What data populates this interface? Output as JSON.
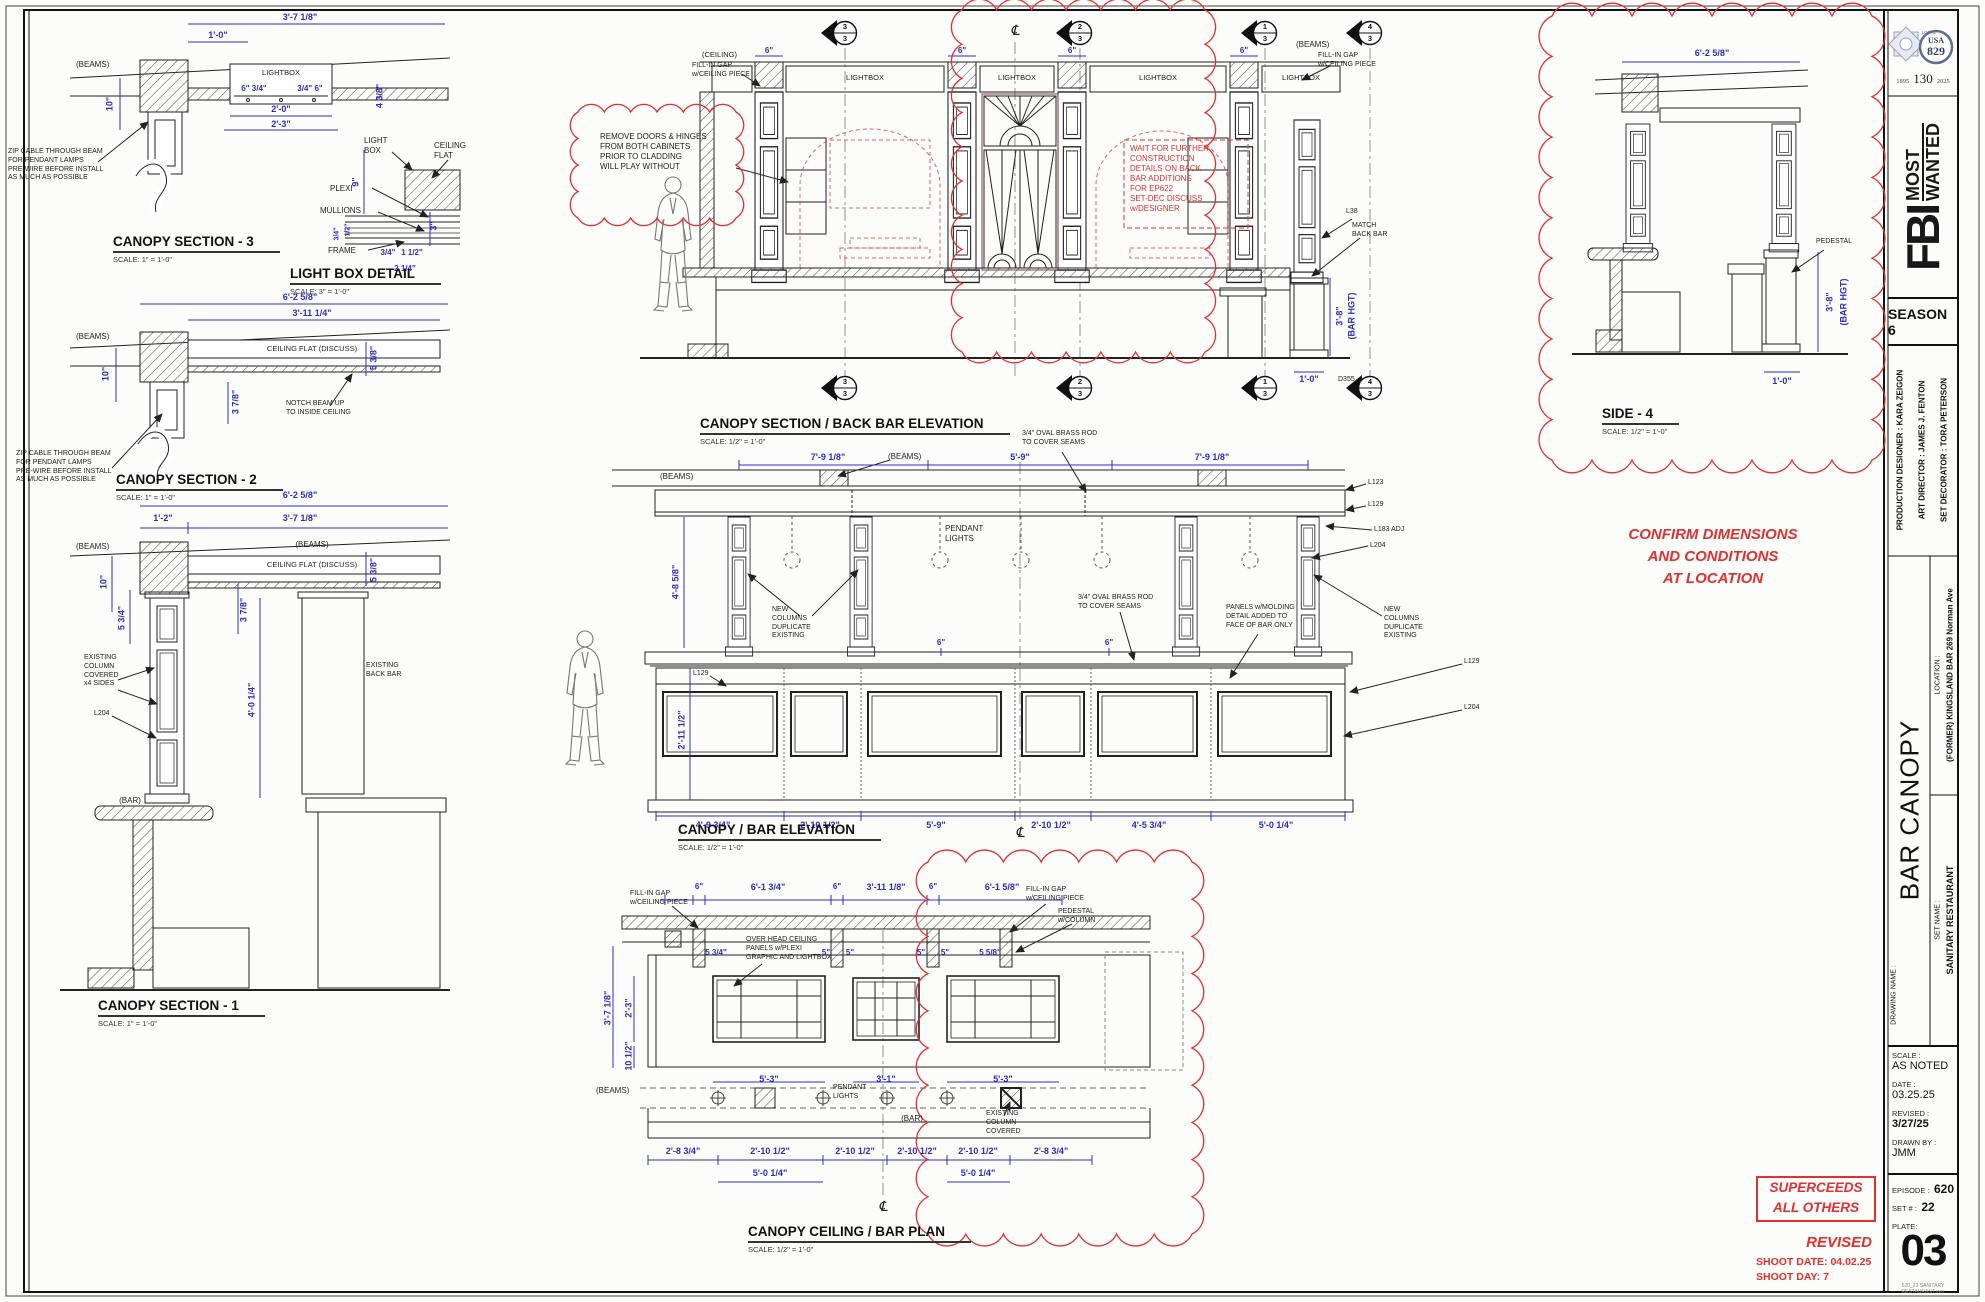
{
  "colors": {
    "dimension": "#2b2bd5",
    "red": "#e42f2f",
    "ink": "#1c1c1c",
    "paper": "#fcfcfa"
  },
  "t": {
    "union": {
      "local": "LOCAL",
      "usa": "USA",
      "num": "829",
      "y1": "1895",
      "y2": "130",
      "y3": "2025"
    },
    "fbi": "FBI",
    "most": "MOST",
    "wanted": "WANTED",
    "season": "SEASON 6",
    "credits": [
      "PRODUCTION DESIGNER : KARA ZEIGON",
      "ART DIRECTOR : JAMES J. FENTON",
      "SET DECORATOR : TORA PETERSON"
    ],
    "loc_label": "LOCATION :",
    "loc": "(FORMER) KINGSLAND BAR 269 Norman Ave",
    "dn_label": "DRAWING NAME :",
    "dn": "BAR CANOPY",
    "sn_label": "SET NAME :",
    "sn": "SANITARY RESTAURANT",
    "scale_label": "SCALE :",
    "scale": "AS NOTED",
    "date_label": "DATE :",
    "date": "03.25.25",
    "rev_label": "REVISED :",
    "rev": "3/27/25",
    "drawn_label": "DRAWN BY :",
    "drawn": "JMM",
    "ep_label": "EPISODE :",
    "ep": "620",
    "set_label": "SET # :",
    "set": "22",
    "plate_label": "PLATE:",
    "plate": "03",
    "file": "620_22 SANITARY RESTAURANT.vwx"
  },
  "st": {
    "sup1": "SUPERCEEDS",
    "sup2": "ALL OTHERS",
    "revised": "REVISED",
    "shoot_date": "SHOOT DATE: 04.02.25",
    "shoot_day": "SHOOT DAY: 7",
    "confirm": "CONFIRM DIMENSIONS\nAND CONDITIONS\nAT LOCATION"
  },
  "n": {
    "beams": "(BEAMS)",
    "ceiling": "(CEILING)",
    "bar": "(BAR)",
    "lightbox": "LIGHTBOX",
    "light_box": "LIGHT\nBOX",
    "ceiling_flat": "CEILING FLAT (DISCUSS)",
    "ceiling_flat2": "CEILING\nFLAT",
    "plexi": "PLEXI",
    "mullions": "MULLIONS",
    "frame": "FRAME",
    "zip": "ZIP CABLE THROUGH BEAM\nFOR PENDANT LAMPS\nPRE-WIRE BEFORE INSTALL\nAS MUCH AS POSSIBLE",
    "notch": "NOTCH BEAM UP\nTO INSIDE CEILING",
    "exist_col": "EXISTING\nCOLUMN\nCOVERED\nx4 SIDES",
    "exist_back": "EXISTING\nBACK BAR",
    "remove": "REMOVE DOORS & HINGES\nFROM BOTH CABINETS\nPRIOR TO CLADDING\nWILL PLAY WITHOUT",
    "wait": "WAIT FOR FURTHER\nCONSTRUCTION\nDETAILS ON BACK\nBAR ADDITIONS\nFOR EP622\nSET-DEC DISCUSS\nw/DESIGNER",
    "fill_gap": "FILL-IN GAP\nw/CEILING PIECE",
    "match": "MATCH\nBACK BAR",
    "pendant": "PENDANT\nLIGHTS",
    "new_cols": "NEW\nCOLUMNS\nDUPLICATE\nEXISTING",
    "brass": "3/4\" OVAL BRASS ROD\nTO COVER SEAMS",
    "panels_mold": "PANELS w/MOLDING\nDETAIL ADDED TO\nFACE OF BAR ONLY",
    "overhead": "OVER HEAD CEILING\nPANELS w/PLEXI\nGRAPHIC AND LIGHTBOX",
    "pedestal": "PEDESTAL",
    "pedestal_col": "PEDESTAL\nw/COLUMN",
    "exist_col2": "EXISTING\nCOLUMN\nCOVERED",
    "l38": "L38",
    "l123": "L123",
    "l129": "L129",
    "l183": "L183 ADJ",
    "l204": "L204",
    "d355": "D355",
    "cl": "℄"
  },
  "mk": {
    "t3": "3",
    "t2": "2",
    "t1": "1",
    "t4": "4",
    "b": "3"
  },
  "v": {
    "s3": {
      "t": "CANOPY SECTION - 3",
      "s": "SCALE: 1\" = 1'-0\"",
      "d": [
        "3'-7 1/8\"",
        "1'-0\"",
        "10\"",
        "6\" 3/4\"",
        "3/4\" 6\"",
        "2'-0\"",
        "2'-3\"",
        "4 3/8\""
      ]
    },
    "lbd": {
      "t": "LIGHT BOX DETAIL",
      "s": "SCALE: 3\" = 1'-0\"",
      "d": [
        "9\"",
        "1/2\"",
        "3/4\"",
        "3/4\"",
        "1 1/2\"",
        "2 1/4\"",
        "3\""
      ]
    },
    "s2": {
      "t": "CANOPY SECTION - 2",
      "s": "SCALE: 1\" = 1'-0\"",
      "d": [
        "6'-2 5/8\"",
        "3'-11 1/4\"",
        "10\"",
        "3 7/8\"",
        "5 3/8\""
      ]
    },
    "s1": {
      "t": "CANOPY SECTION - 1",
      "s": "SCALE: 1\" = 1'-0\"",
      "d": [
        "6'-2 5/8\"",
        "1'-2\"",
        "3'-7 1/8\"",
        "10\"",
        "5 3/4\"",
        "3 7/8\"",
        "5 3/8\"",
        "4'-0 1/4\""
      ]
    },
    "bbe": {
      "t": "CANOPY SECTION / BACK BAR ELEVATION",
      "s": "SCALE: 1/2\" = 1'-0\"",
      "d": [
        "6\"",
        "3'-8\"",
        "(BAR HGT)",
        "1'-0\""
      ]
    },
    "cbe": {
      "t": "CANOPY / BAR ELEVATION",
      "s": "SCALE: 1/2\" = 1'-0\"",
      "d": [
        "7'-9 1/8\"",
        "5'-9\"",
        "7'-9 1/8\"",
        "4'-8 5/8\"",
        "2'-11 1/2\"",
        "6\"",
        "4'-9 3/4\"",
        "2'-10 1/2\"",
        "5'-9\"",
        "2'-10 1/2\"",
        "4'-5 3/4\"",
        "5'-0 1/4\""
      ]
    },
    "plan": {
      "t": "CANOPY CEILING / BAR PLAN",
      "s": "SCALE: 1/2\" = 1'-0\"",
      "d": [
        "6\"",
        "6'-1 3/4\"",
        "3'-11 1/8\"",
        "6'-1 5/8\"",
        "5 3/4\"",
        "5\"",
        "5 5/8\"",
        "3'-7 1/8\"",
        "2'-3\"",
        "10 1/2\"",
        "5'-3\"",
        "3'-1\"",
        "2'-8 3/4\"",
        "2'-10 1/2\"",
        "5'-0 1/4\""
      ]
    },
    "side4": {
      "t": "SIDE - 4",
      "s": "SCALE: 1/2\" = 1'-0\"",
      "d": [
        "6'-2 5/8\"",
        "3'-8\"",
        "(BAR HGT)",
        "1'-0\""
      ]
    }
  }
}
